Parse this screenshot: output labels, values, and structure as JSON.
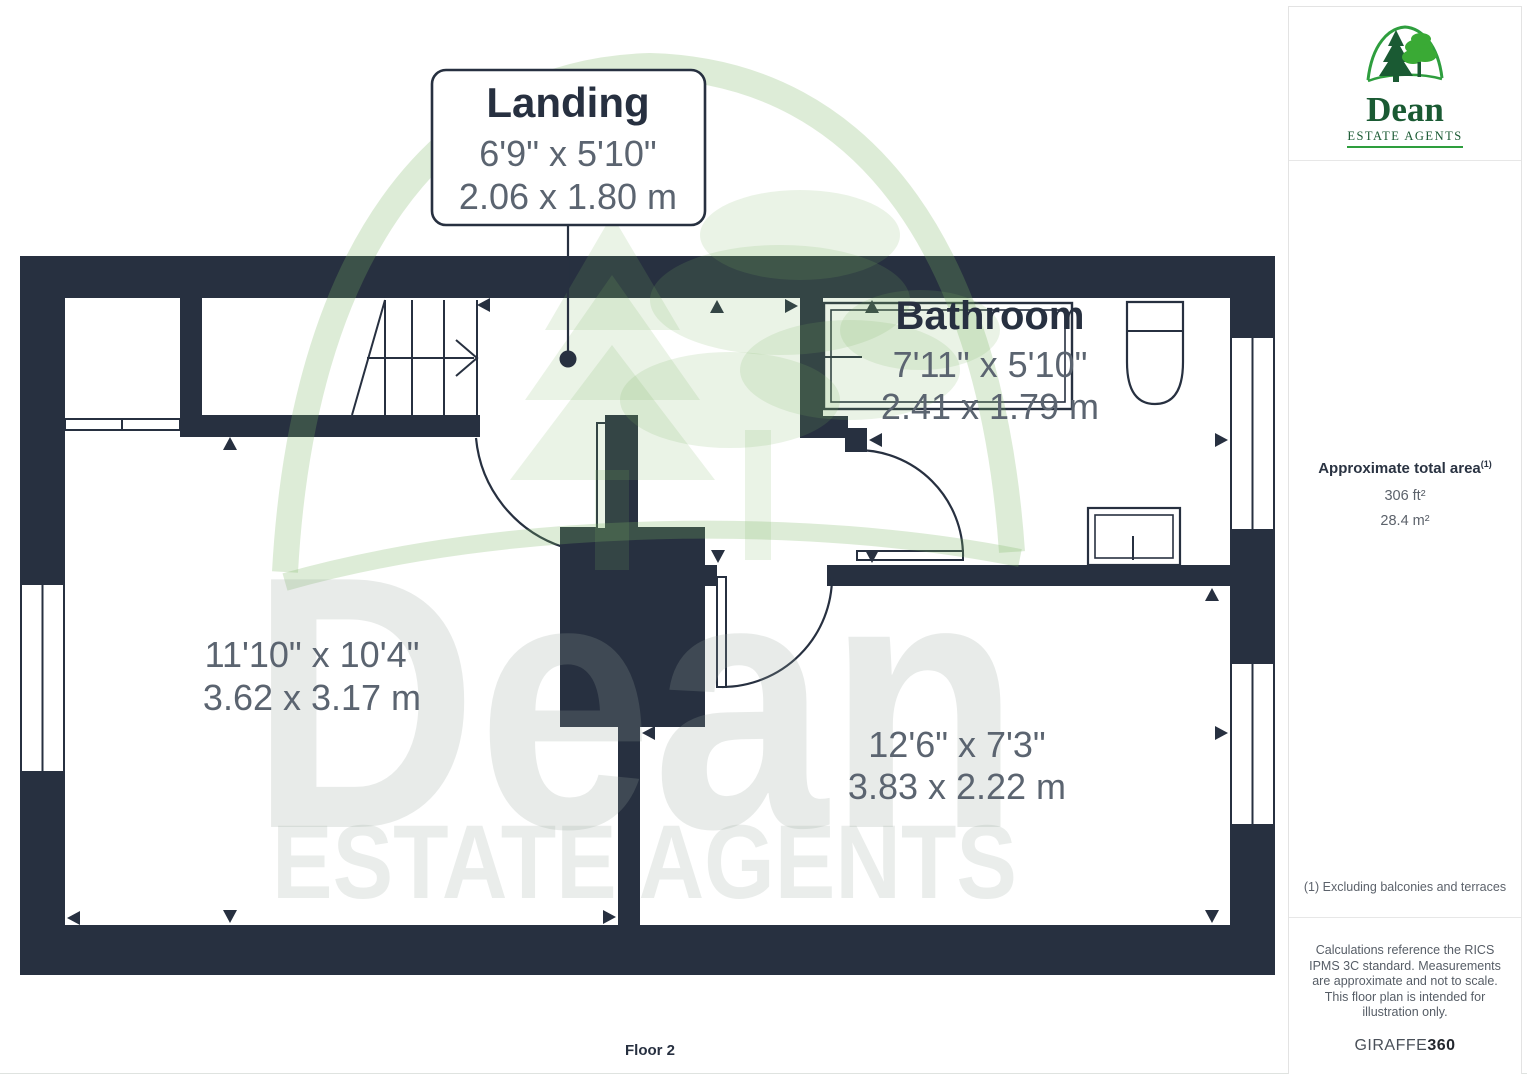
{
  "plan": {
    "floor_label": "Floor 2",
    "landing": {
      "title": "Landing",
      "imperial": "6'9\" x 5'10\"",
      "metric": "2.06 x 1.80 m"
    },
    "bathroom": {
      "title": "Bathroom",
      "imperial": "7'11\" x 5'10\"",
      "metric": "2.41 x 1.79 m"
    },
    "bedroom1": {
      "imperial": "11'10\" x 10'4\"",
      "metric": "3.62 x 3.17 m"
    },
    "bedroom2": {
      "imperial": "12'6\" x 7'3\"",
      "metric": "3.83 x 2.22 m"
    },
    "watermark": {
      "word": "Dean",
      "subword": "ESTATE AGENTS"
    }
  },
  "sidebar": {
    "logo": {
      "word": "Dean",
      "subword": "ESTATE AGENTS"
    },
    "area": {
      "title": "Approximate total area",
      "sup": "(1)",
      "imperial": "306 ft²",
      "metric": "28.4 m²"
    },
    "footnote": "(1) Excluding balconies and terraces",
    "disclaimer": "Calculations reference the RICS IPMS 3C standard. Measurements are approximate and not to scale. This floor plan is intended for illustration only.",
    "brand_regular": "GIRAFFE",
    "brand_bold": "360"
  },
  "colors": {
    "wall": "#273040",
    "dim_text": "#5b6470",
    "logo_green_dark": "#1a5a33",
    "logo_green_bright": "#3aaa35",
    "logo_arch_green": "#2e9e3e",
    "watermark_green": "rgba(125,180,100,0.28)"
  }
}
